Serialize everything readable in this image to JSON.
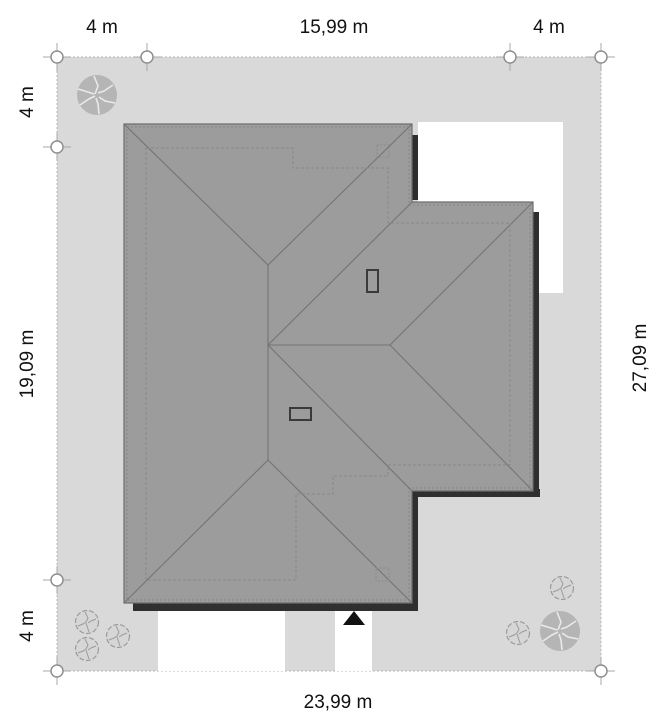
{
  "plan": {
    "type": "roof site plan",
    "dimensions": {
      "top": [
        "4 m",
        "15,99 m",
        "4 m"
      ],
      "left": [
        "4 m",
        "19,09 m",
        "4 m"
      ],
      "right": [
        "27,09 m"
      ],
      "bottom": [
        "23,99 m"
      ]
    },
    "colors": {
      "plot": "#d9d9d9",
      "roof": "#9c9c9c",
      "edge_shadow": "#2f2f2f",
      "paving": "#ffffff",
      "tree": "#b5b5b5",
      "arrow": "#111111",
      "text": "#111111"
    }
  }
}
